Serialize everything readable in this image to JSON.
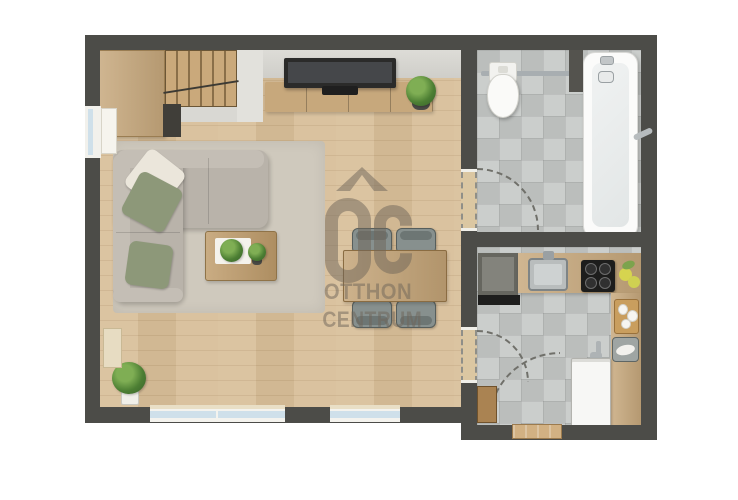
{
  "image_type": "floor-plan-rendering",
  "watermark": {
    "logo": "OC",
    "line1": "OTTHON",
    "line2": "CENTRUM",
    "symbol": "roof-chevron"
  },
  "colors": {
    "background": "#ffffff",
    "wall": "#4c4c48",
    "wood_floor": "#d8bf9a",
    "tile_floor": "#c5c8c6",
    "rug": "#cfc9bd",
    "sofa": "#b9b3aa",
    "sofa_back": "#c4beb5",
    "pillow_green": "#8d9879",
    "pillow_white": "#ebe6db",
    "furniture_wood": "#c7a87c",
    "window_glass": "#cfe0ea",
    "appliance_white": "#f7f7f5",
    "appliance_dark": "#66665f",
    "chair": "#87908e",
    "watermark": "#6f665a"
  },
  "rooms": [
    {
      "name": "living-room-with-stairs-and-dining",
      "floor": "wood"
    },
    {
      "name": "bathroom",
      "floor": "tile"
    },
    {
      "name": "kitchen-hall",
      "floor": "tile"
    }
  ],
  "furniture": [
    {
      "name": "staircase",
      "room": "living-room"
    },
    {
      "name": "tv-console",
      "room": "living-room"
    },
    {
      "name": "tv",
      "room": "living-room"
    },
    {
      "name": "console-plant",
      "room": "living-room"
    },
    {
      "name": "corner-sofa",
      "room": "living-room"
    },
    {
      "name": "pillows",
      "count": 3,
      "room": "living-room"
    },
    {
      "name": "rug",
      "room": "living-room"
    },
    {
      "name": "coffee-table",
      "room": "living-room"
    },
    {
      "name": "dining-table",
      "room": "living-room"
    },
    {
      "name": "dining-chairs",
      "count": 4,
      "room": "living-room"
    },
    {
      "name": "floor-plant",
      "room": "living-room"
    },
    {
      "name": "wall-hung-toilet",
      "room": "bathroom"
    },
    {
      "name": "towel-rail",
      "room": "bathroom"
    },
    {
      "name": "bathtub",
      "room": "bathroom"
    },
    {
      "name": "refrigerator",
      "room": "kitchen"
    },
    {
      "name": "kitchen-sink",
      "room": "kitchen"
    },
    {
      "name": "cooktop",
      "room": "kitchen"
    },
    {
      "name": "lemons",
      "room": "kitchen"
    },
    {
      "name": "cutting-board",
      "room": "kitchen"
    },
    {
      "name": "fish-tray",
      "room": "kitchen"
    },
    {
      "name": "washing-machine",
      "room": "kitchen"
    },
    {
      "name": "hall-cabinet",
      "room": "kitchen"
    },
    {
      "name": "entrance-threshold",
      "room": "kitchen"
    },
    {
      "name": "door-swing-arcs",
      "count": 3
    },
    {
      "name": "windows",
      "count": 3
    }
  ]
}
